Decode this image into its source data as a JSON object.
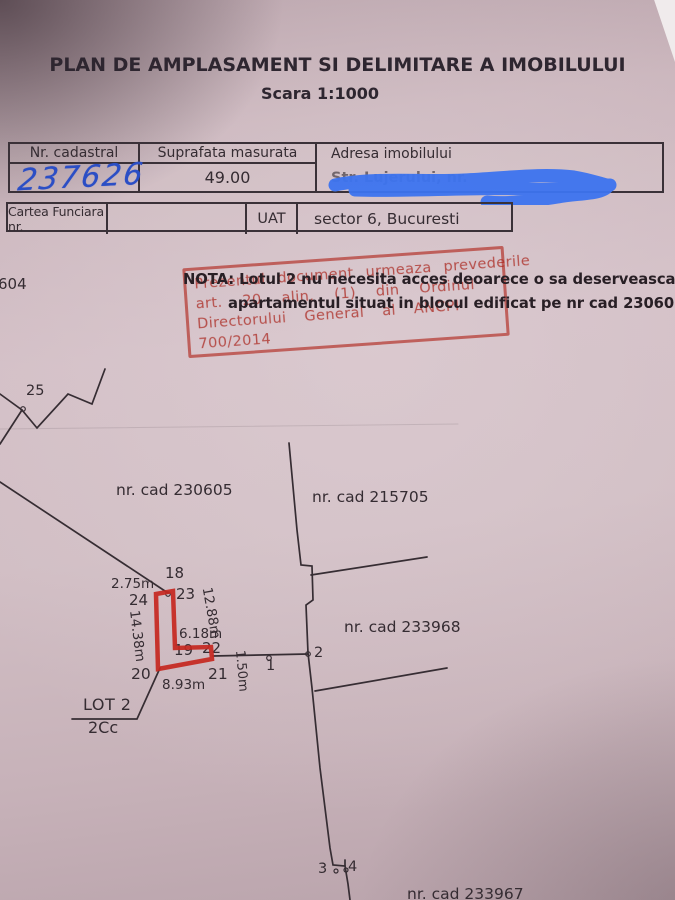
{
  "title": {
    "main": "PLAN DE AMPLASAMENT SI DELIMITARE A IMOBILULUI",
    "scale": "Scara 1:1000"
  },
  "table1": {
    "col1_header": "Nr. cadastral",
    "col2_header": "Suprafata masurata",
    "col3_header": "Adresa imobilului",
    "nr_cadastral": "237626",
    "suprafata": "49.00",
    "adresa_partial": "Str. Lujerului, nr."
  },
  "table2": {
    "cartea_label": "Cartea Funciara nr.",
    "uat_label": "UAT",
    "uat_value": "sector 6, Bucuresti"
  },
  "nota": {
    "line1": "NOTA: Lotul 2 nu necesita acces deoarece o sa deserveasca",
    "line2": "apartamentul situat in blocul edificat pe nr cad 230605"
  },
  "stamp": {
    "line1": "Prezentul document urmeaza prevederile",
    "line2": "art. 20 alin. (1) din Ordinul",
    "line3": "Directorului General al ANCPI",
    "line4": "700/2014"
  },
  "plan": {
    "ref_604": "604",
    "parcel_230605": "nr. cad 230605",
    "parcel_215705": "nr. cad 215705",
    "parcel_233968": "nr. cad 233968",
    "parcel_233967": "nr. cad 233967",
    "lot_name": "LOT 2",
    "lot_code": "2Cc",
    "points": {
      "p1": "1",
      "p2": "2",
      "p3": "3",
      "p4": "4",
      "p18": "18",
      "p19": "19",
      "p20": "20",
      "p21": "21",
      "p22": "22",
      "p23": "23",
      "p24": "24",
      "p25": "25"
    },
    "measures": {
      "top": "2.75m",
      "left": "14.38m",
      "right": "12.88m",
      "inner": "6.18m",
      "bottom": "8.93m",
      "end": "1.50m"
    }
  },
  "colors": {
    "paper": "#cdb9bf",
    "ink": "#352c32",
    "stamp_red": "#b5362c",
    "outline_red": "#c6271f",
    "pen_blue": "#2b4ec5",
    "marker_blue": "#3d74f0"
  }
}
